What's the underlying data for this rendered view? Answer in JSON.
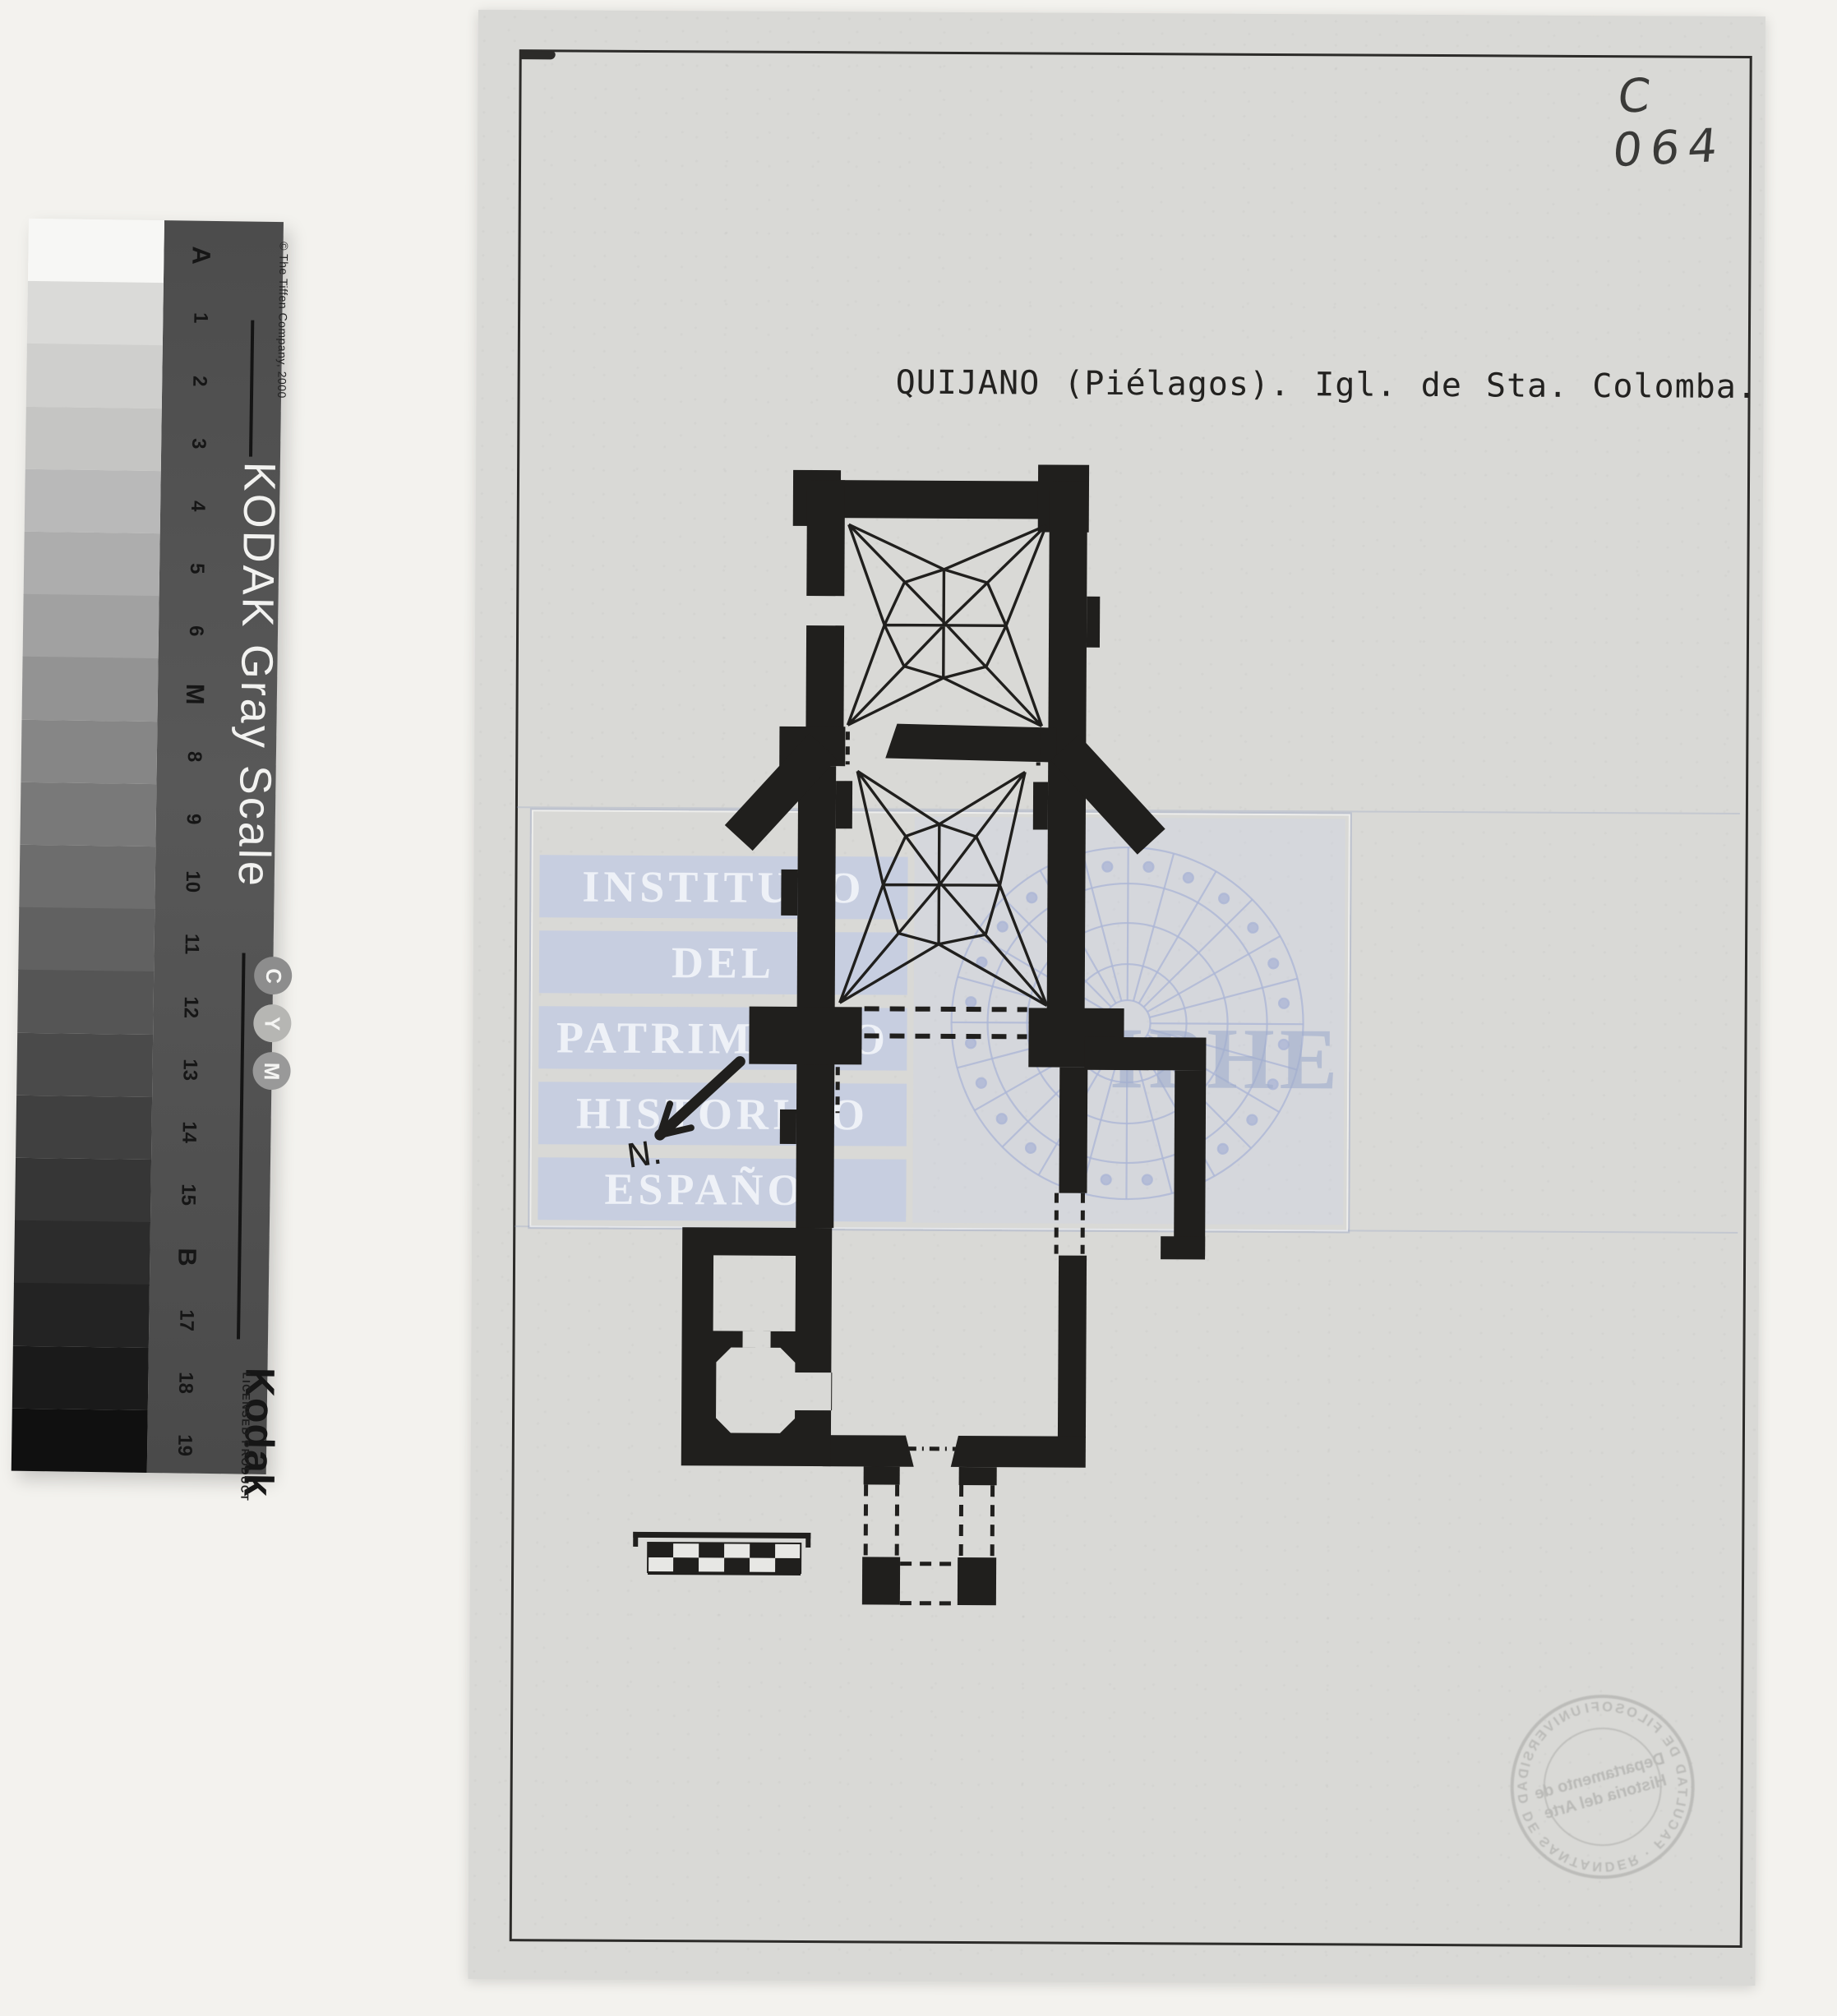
{
  "colors": {
    "background": "#f3f2ee",
    "paper": "#d9d9d6",
    "ink": "#201f1d",
    "watermark_band": "#c7cee0",
    "watermark_text": "#eef1f7",
    "ruler_backing": "#4f4f4f"
  },
  "ruler": {
    "brand_title": "KODAK Gray Scale",
    "copyright": "© The Tiffen Company, 2000",
    "logo": "Kodak",
    "licensed": "LICENSED PRODUCT",
    "cym": [
      {
        "letter": "C",
        "color": "#8d8d8d"
      },
      {
        "letter": "Y",
        "color": "#b6b6b3"
      },
      {
        "letter": "M",
        "color": "#999999"
      }
    ],
    "patches": [
      {
        "label": "A",
        "color": "#f7f7f5",
        "key": true
      },
      {
        "label": "1",
        "color": "#dadad8",
        "key": false
      },
      {
        "label": "2",
        "color": "#cfcfcd",
        "key": false
      },
      {
        "label": "3",
        "color": "#c5c5c3",
        "key": false
      },
      {
        "label": "4",
        "color": "#b9b9b9",
        "key": false
      },
      {
        "label": "5",
        "color": "#adadad",
        "key": false
      },
      {
        "label": "6",
        "color": "#a1a1a1",
        "key": false
      },
      {
        "label": "M",
        "color": "#939393",
        "key": true
      },
      {
        "label": "8",
        "color": "#868686",
        "key": false
      },
      {
        "label": "9",
        "color": "#797979",
        "key": false
      },
      {
        "label": "10",
        "color": "#6d6d6d",
        "key": false
      },
      {
        "label": "11",
        "color": "#616161",
        "key": false
      },
      {
        "label": "12",
        "color": "#555555",
        "key": false
      },
      {
        "label": "13",
        "color": "#4a4a4a",
        "key": false
      },
      {
        "label": "14",
        "color": "#404040",
        "key": false
      },
      {
        "label": "15",
        "color": "#363636",
        "key": false
      },
      {
        "label": "B",
        "color": "#2c2c2c",
        "key": true
      },
      {
        "label": "17",
        "color": "#232323",
        "key": false
      },
      {
        "label": "18",
        "color": "#1a1a1a",
        "key": false
      },
      {
        "label": "19",
        "color": "#101010",
        "key": false
      }
    ]
  },
  "document": {
    "catalog_number": "C 064",
    "title": "QUIJANO (Piélagos).  Igl. de  Sta. Colomba.",
    "north_label": "N.",
    "watermark": {
      "lines": [
        "INSTITUTO",
        "DEL",
        "PATRIMONIO",
        "HISTORICO",
        "ESPAÑOL"
      ],
      "acronym": "IPHE"
    },
    "stamp": {
      "ring_text": "UNIVERSIDAD DE SANTANDER · FACULTAD DE FILOSOFIA Y LETRAS ·",
      "center_line1": "Departamento de",
      "center_line2": "Historia del Arte"
    },
    "scale_bar": {
      "rows": 2,
      "cols": 6
    }
  }
}
